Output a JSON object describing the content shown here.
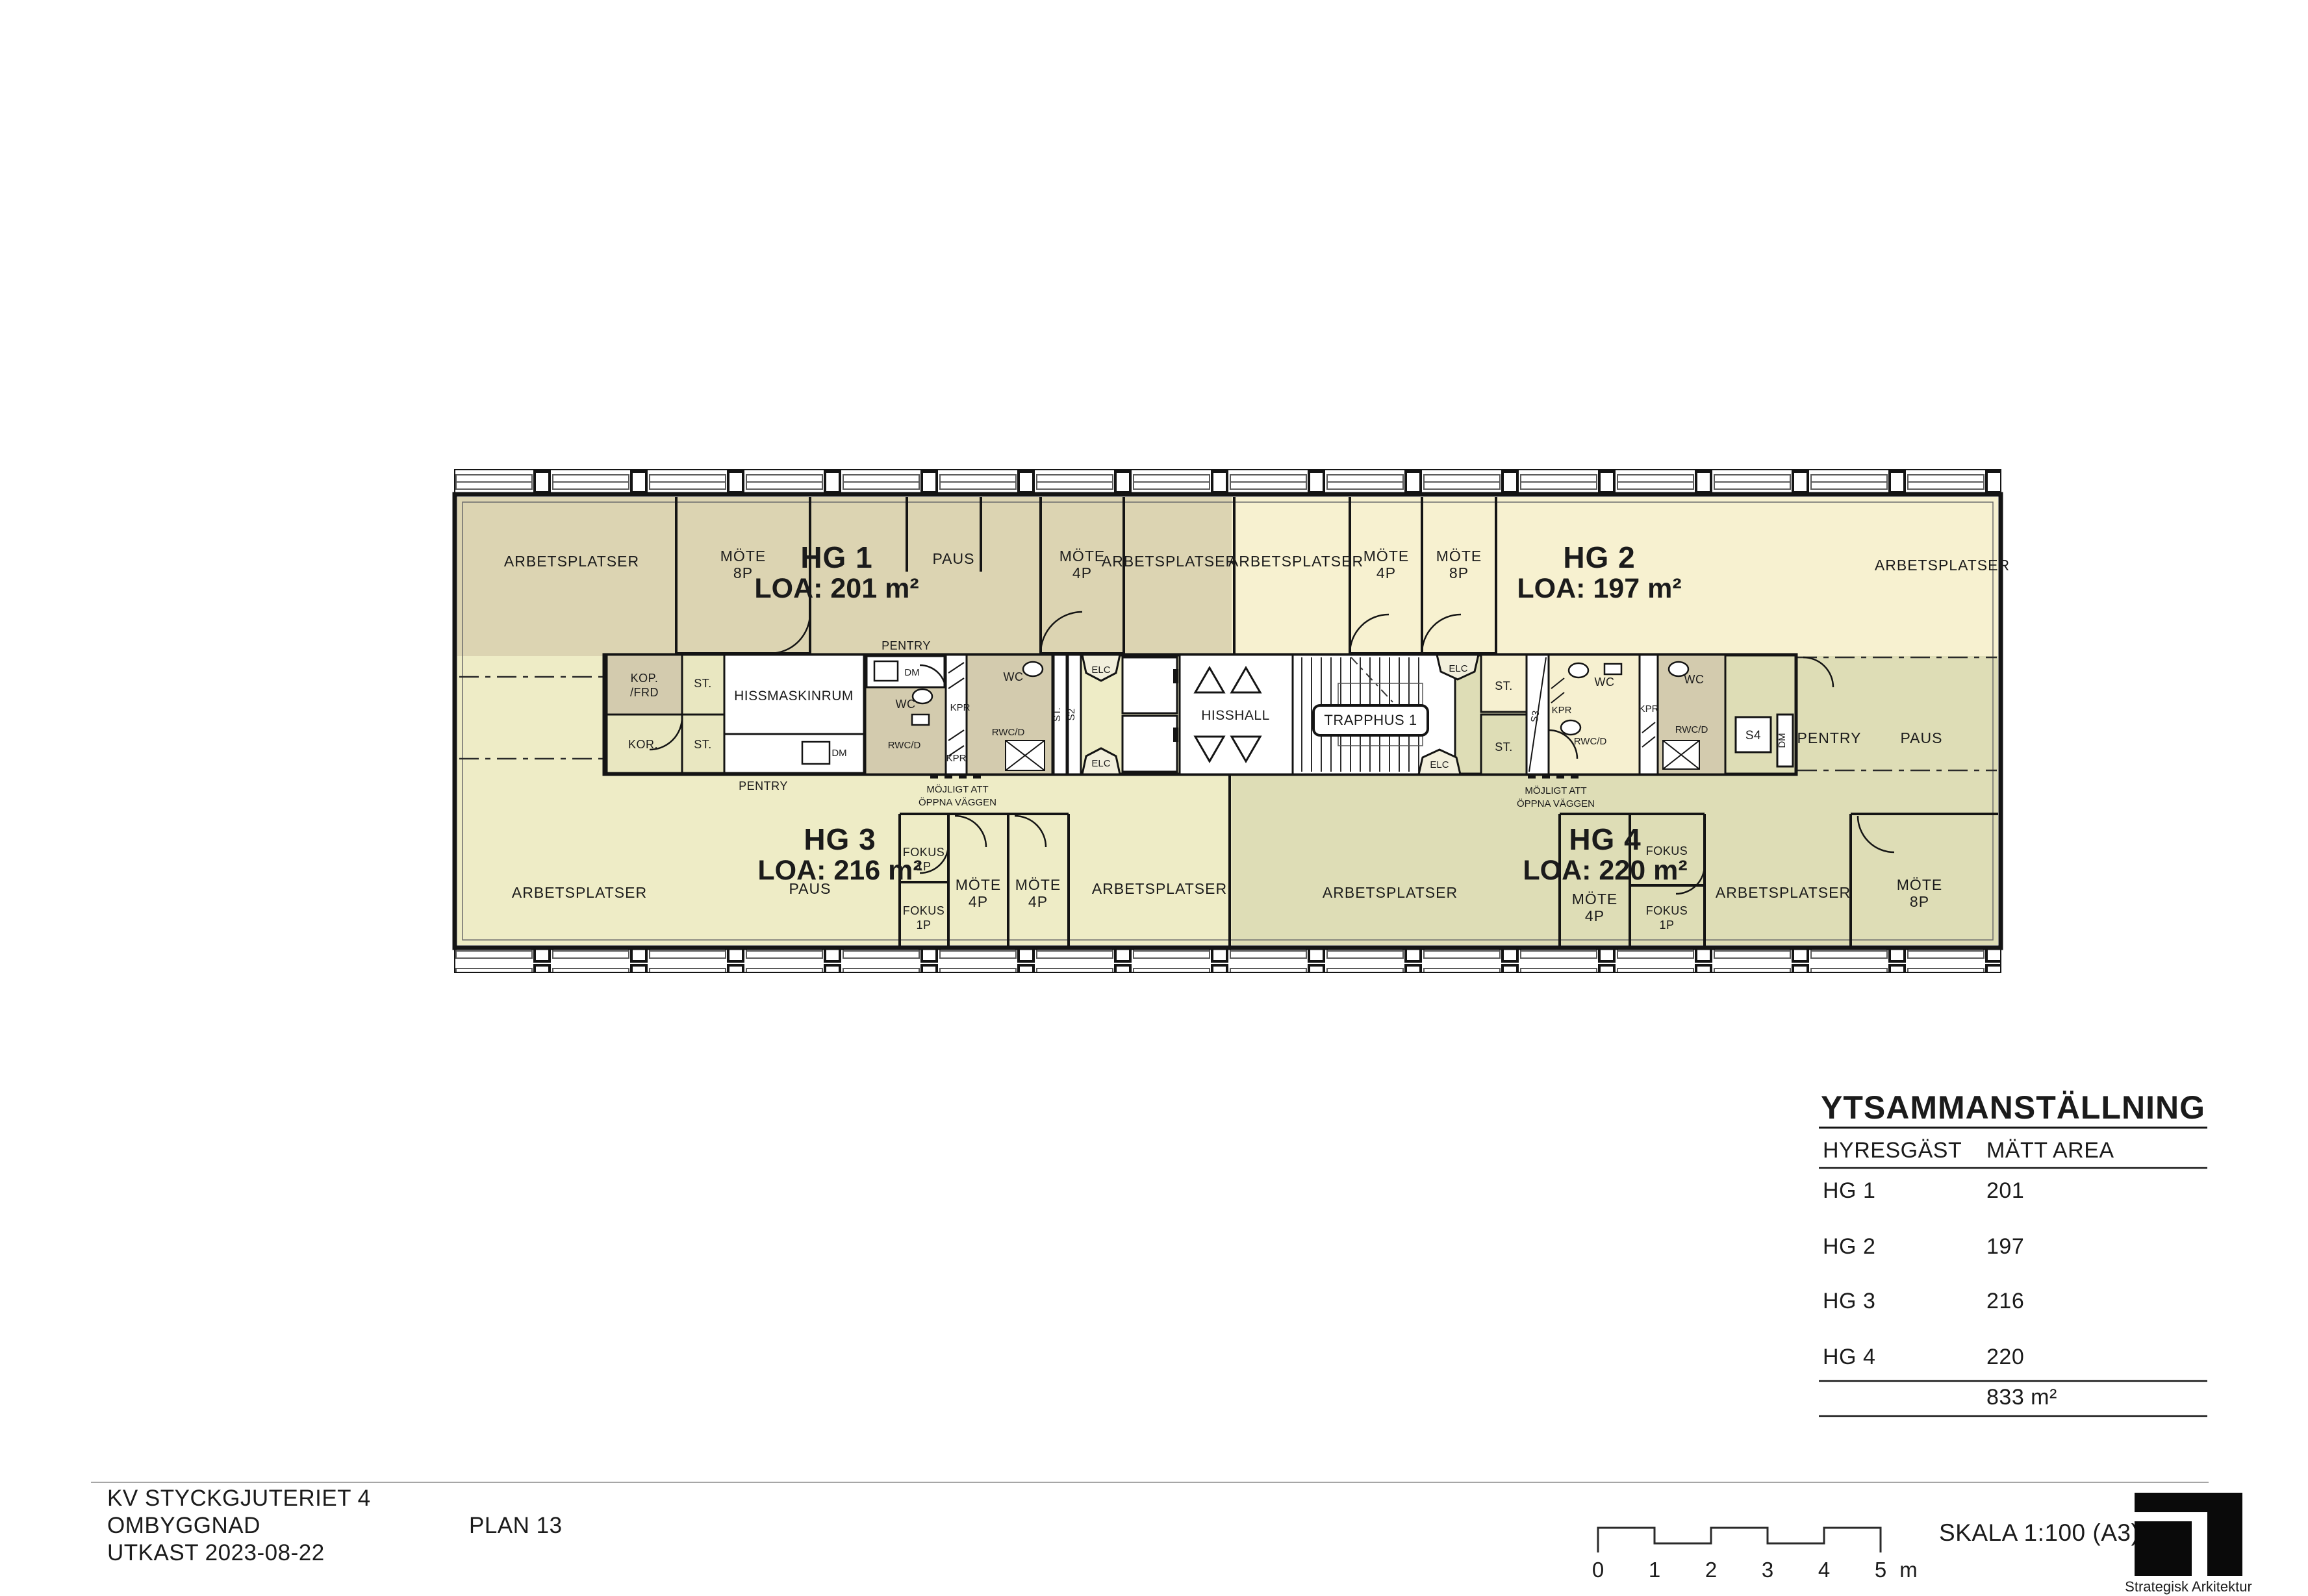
{
  "drawing": {
    "project_line1": "KV STYCKGJUTERIET 4",
    "project_line2": "OMBYGGNAD",
    "project_line3": "UTKAST 2023-08-22",
    "plan_label": "PLAN 13",
    "scale_label": "SKALA 1:100 (A3)",
    "logo_text": "Strategisk Arkitektur"
  },
  "scale_bar": {
    "t0": "0",
    "t1": "1",
    "t2": "2",
    "t3": "3",
    "t4": "4",
    "t5": "5",
    "unit": "m"
  },
  "area_table": {
    "title": "YTSAMMANSTÄLLNING",
    "col_tenant": "HYRESGÄST",
    "col_area": "MÄTT AREA",
    "rows": [
      {
        "tenant": "HG 1",
        "area": "201"
      },
      {
        "tenant": "HG 2",
        "area": "197"
      },
      {
        "tenant": "HG 3",
        "area": "216"
      },
      {
        "tenant": "HG 4",
        "area": "220"
      }
    ],
    "total": "833 m²"
  },
  "tenants": [
    {
      "name": "HG 1",
      "loa": "LOA: 201 m²",
      "color": "#dcd4b2"
    },
    {
      "name": "HG 2",
      "loa": "LOA: 197 m²",
      "color": "#f7f1d0"
    },
    {
      "name": "HG 3",
      "loa": "LOA: 216 m²",
      "color": "#eeecc6"
    },
    {
      "name": "HG 4",
      "loa": "LOA: 220 m²",
      "color": "#deddb6"
    }
  ],
  "rooms": {
    "arbetsplatser": "ARBETSPLATSER",
    "mote": "MÖTE",
    "p8": "8P",
    "p4": "4P",
    "p1": "1P",
    "paus": "PAUS",
    "fokus": "FOKUS",
    "pentry": "PENTRY",
    "dm": "DM",
    "wc": "WC",
    "rwcd": "RWC/D",
    "kpr": "KPR",
    "elc": "ELC",
    "st": "ST.",
    "s2": "S2",
    "s3": "S3",
    "s4": "S4",
    "kop": "KOP.",
    "frd": "/FRD",
    "kor": "KOR.",
    "hissmaskinrum": "HISSMASKINRUM",
    "hisshall": "HISSHALL",
    "trapphus": "TRAPPHUS 1",
    "open1": "MÖJLIGT ATT",
    "open2": "ÖPPNA VÄGGEN"
  }
}
